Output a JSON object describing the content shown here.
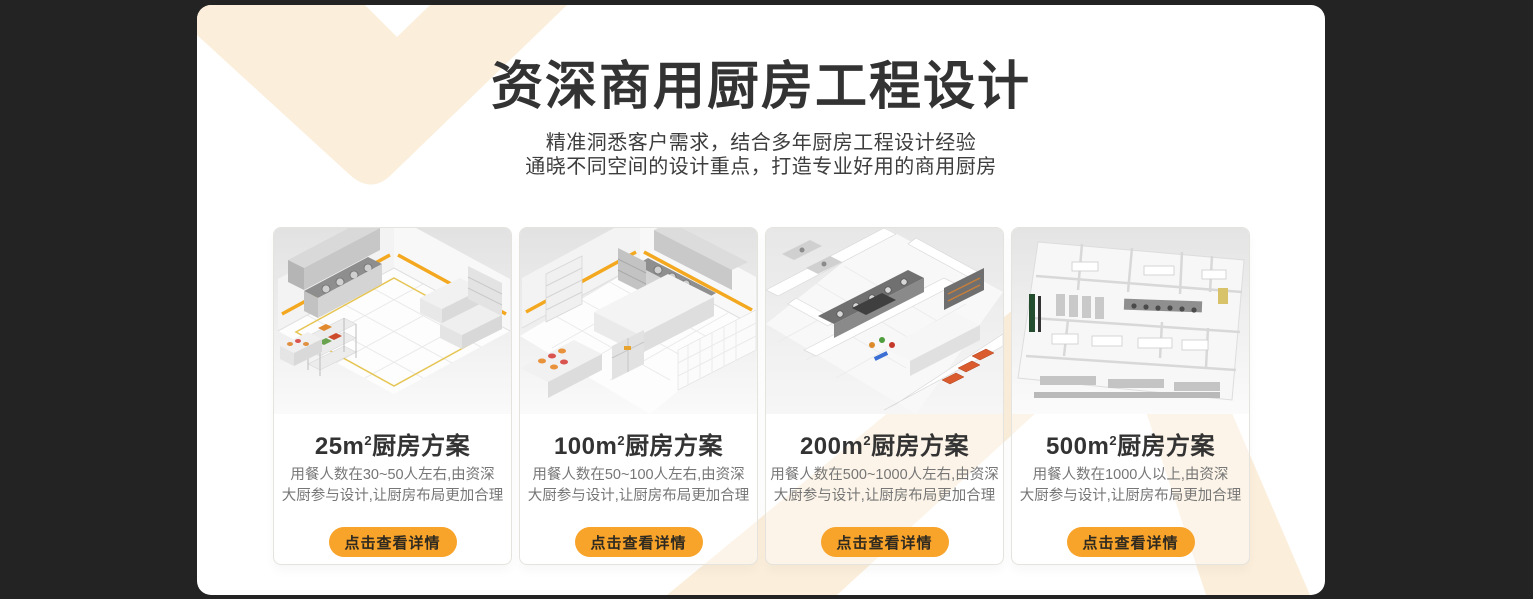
{
  "theme": {
    "page_background": "#232323",
    "panel_background": "#ffffff",
    "decor_cream": "#fbeeda",
    "accent_orange": "#f8a32a",
    "title_color": "#333333",
    "description_color": "#767676"
  },
  "header": {
    "title": "资深商用厨房工程设计",
    "subtitle_line1": "精准洞悉客户需求，结合多年厨房工程设计经验",
    "subtitle_line2": "通晓不同空间的设计重点，打造专业好用的商用厨房"
  },
  "cards": [
    {
      "title_prefix": "25m",
      "title_sup": "2",
      "title_suffix": "厨房方案",
      "description_line1": "用餐人数在30~50人左右,由资深",
      "description_line2": "大厨参与设计,让厨房布局更加合理",
      "button_label": "点击查看详情",
      "image_alt": "25平方米商用厨房等轴测效果图"
    },
    {
      "title_prefix": "100m",
      "title_sup": "2",
      "title_suffix": "厨房方案",
      "description_line1": "用餐人数在50~100人左右,由资深",
      "description_line2": "大厨参与设计,让厨房布局更加合理",
      "button_label": "点击查看详情",
      "image_alt": "100平方米商用厨房等轴测效果图"
    },
    {
      "title_prefix": "200m",
      "title_sup": "2",
      "title_suffix": "厨房方案",
      "description_line1": "用餐人数在500~1000人左右,由资深",
      "description_line2": "大厨参与设计,让厨房布局更加合理",
      "button_label": "点击查看详情",
      "image_alt": "200平方米商用厨房等轴测效果图"
    },
    {
      "title_prefix": "500m",
      "title_sup": "2",
      "title_suffix": "厨房方案",
      "description_line1": "用餐人数在1000人以上,由资深",
      "description_line2": "大厨参与设计,让厨房布局更加合理",
      "button_label": "点击查看详情",
      "image_alt": "500平方米商用厨房等轴测效果图"
    }
  ]
}
